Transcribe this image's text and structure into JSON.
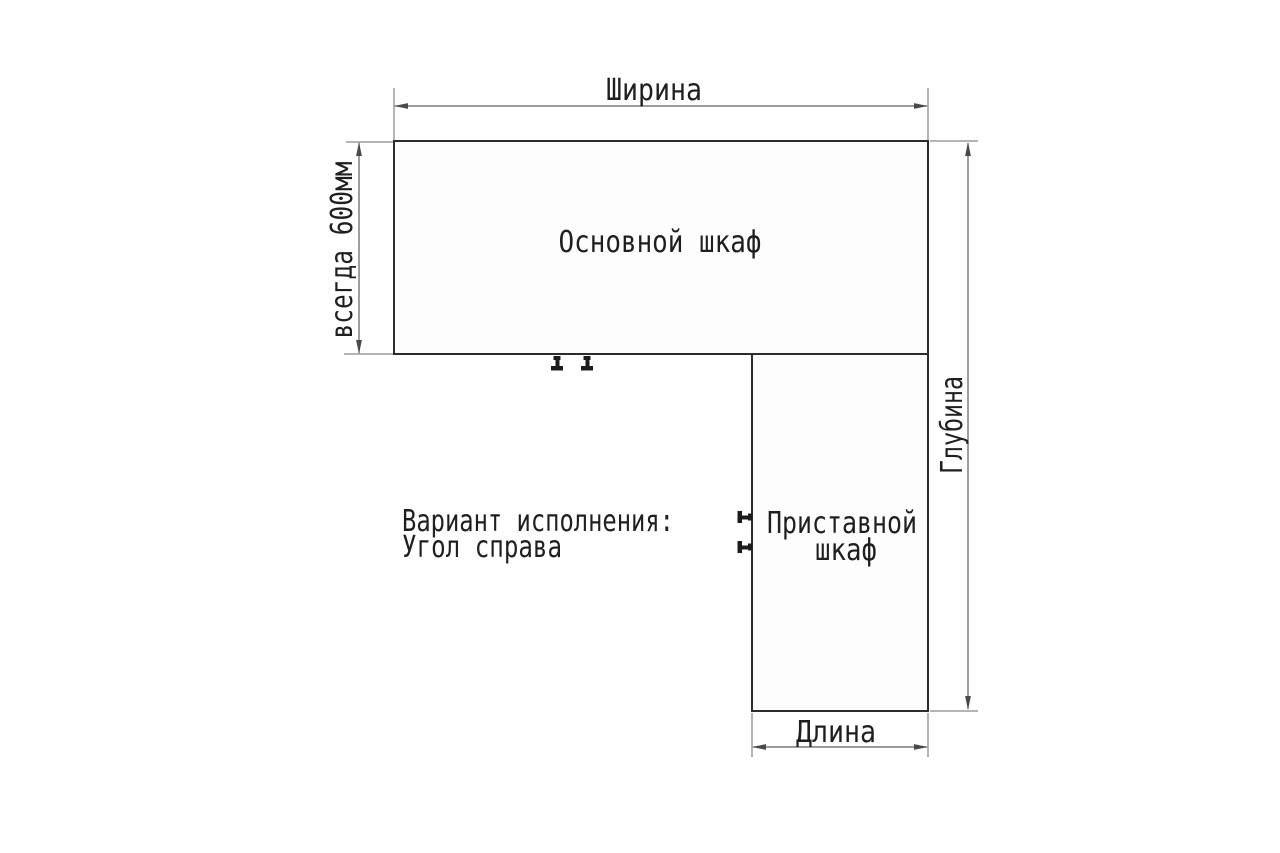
{
  "diagram": {
    "type": "furniture-dimension-scheme",
    "labels": {
      "width": "Ширина",
      "depth": "Глубина",
      "length": "Длина",
      "left_note": "всегда 600мм",
      "main_cabinet": "Основной шкаф",
      "attached_cabinet_line1": "Приставной",
      "attached_cabinet_line2": "шкаф",
      "variant_line1": "Вариант исполнения:",
      "variant_line2": "Угол справа"
    },
    "colors": {
      "background": "#ffffff",
      "cabinet_outline": "#2c2c2c",
      "dimension_lines": "#5f5f5f",
      "text": "#1f1f1f"
    }
  }
}
